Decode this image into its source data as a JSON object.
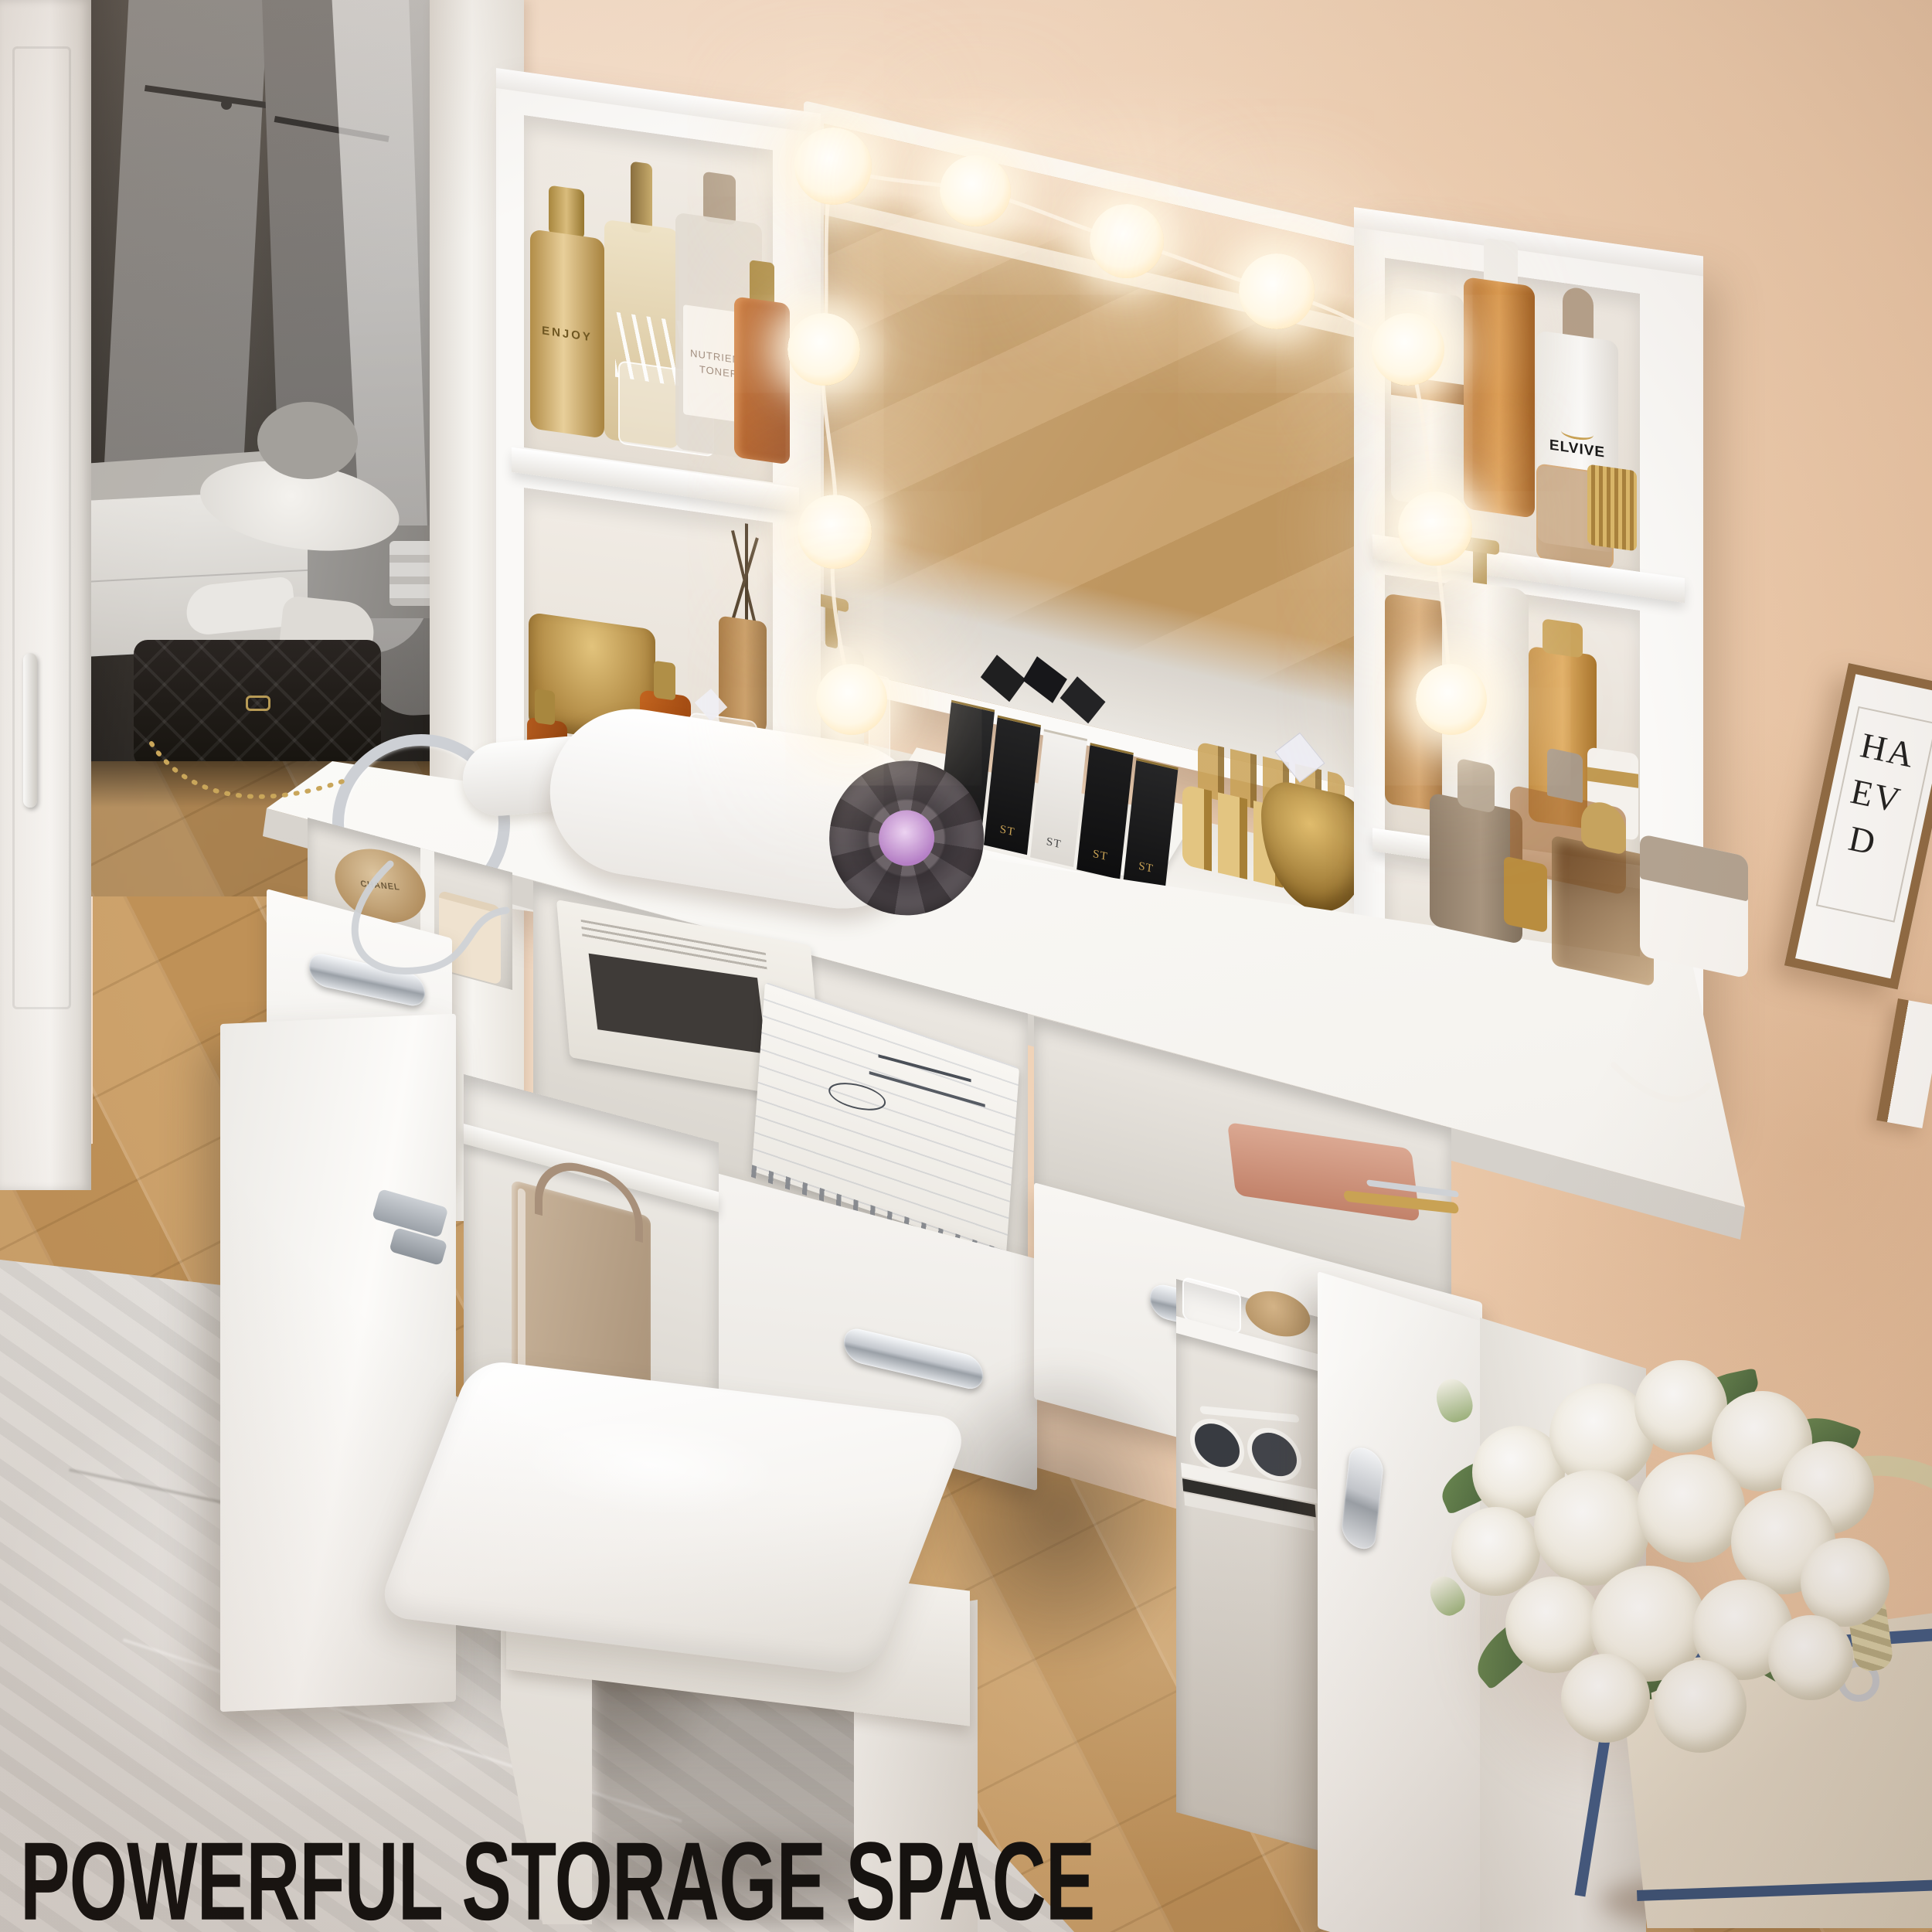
{
  "headline": "POWERFUL STORAGE SPACE",
  "poster": {
    "line1": "HA",
    "line2": "EV",
    "line3": "D"
  },
  "products": {
    "hair_spray_label": "ENJOY",
    "toner_label_line1": "NUTRIENT",
    "toner_label_line2": "TONER",
    "shampoo_label": "ELVIVE",
    "lipstick_box_label": "ST",
    "powder_label": "CHANEL"
  },
  "colors": {
    "wall": "#f2d5bb",
    "floor_wood": "#c59a63",
    "furniture_white": "#f9f8f6",
    "rug": "#e2e0dd",
    "headline_text": "#0b0b0b",
    "chrome": "#c6cad0",
    "gold": "#c9a254",
    "navy_trim": "#3c5884",
    "poster_wood": "#96714a"
  }
}
